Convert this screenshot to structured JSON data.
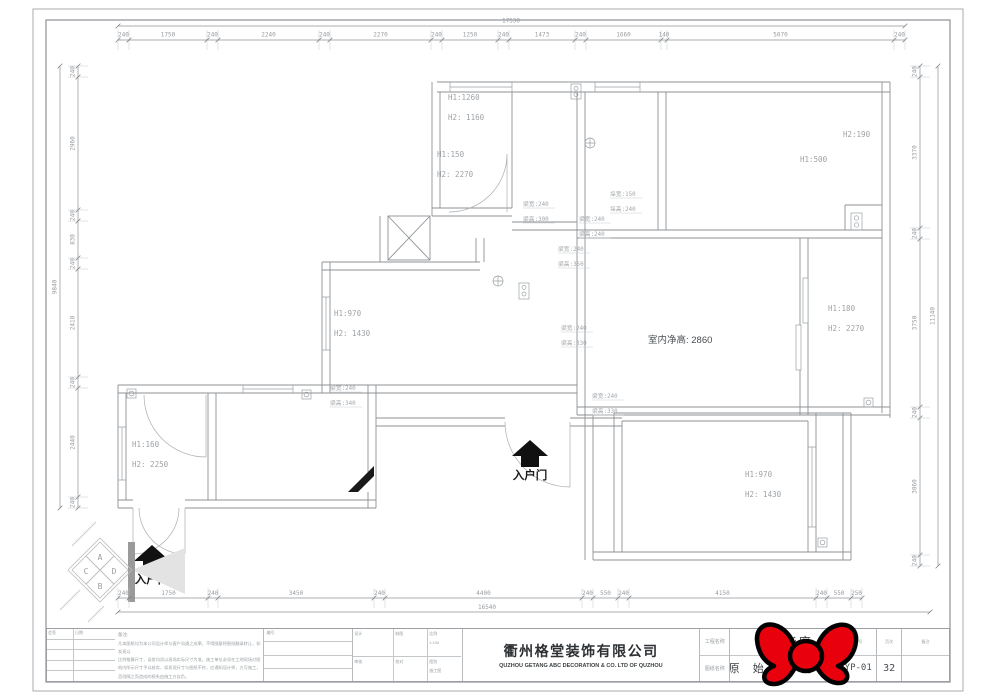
{
  "colors": {
    "line": "#8d9195",
    "dim_text": "#989ca0",
    "room_text": "#9ea2a6",
    "beam_text": "#a3a7ab",
    "dark_text": "#3c4043",
    "sticker_red": "#e8000d"
  },
  "dimensions": {
    "top": {
      "overall": "17530",
      "segments": [
        "240",
        "1750",
        "240",
        "2240",
        "240",
        "2270",
        "240",
        "1250",
        "240",
        "1473",
        "240",
        "1660",
        "140",
        "5070",
        "240"
      ]
    },
    "bottom": {
      "overall": "16540",
      "segments": [
        "240",
        "1750",
        "240",
        "3450",
        "240",
        "4400",
        "240",
        "550",
        "240",
        "4150",
        "240",
        "550",
        "250"
      ]
    },
    "left": {
      "overall": "9840",
      "segments": [
        "240",
        "2960",
        "240",
        "830",
        "240",
        "2410",
        "240",
        "2440",
        "240"
      ]
    },
    "right": {
      "overall": "11140",
      "segments": [
        "240",
        "3370",
        "240",
        "3750",
        "240",
        "3060",
        "240"
      ]
    }
  },
  "room_labels": [
    {
      "lines": [
        "H1:1260",
        "H2: 1160"
      ]
    },
    {
      "lines": [
        "H1:150",
        "H2: 2270"
      ]
    },
    {
      "lines": [
        "H1:500"
      ]
    },
    {
      "lines": [
        "H2:190"
      ]
    },
    {
      "lines": [
        "H1:970",
        "H2: 1430"
      ]
    },
    {
      "lines": [
        "H1:160",
        "H2: 2250"
      ]
    },
    {
      "lines": [
        "H1:180",
        "H2: 2270"
      ]
    },
    {
      "lines": [
        "H1:970",
        "H2: 1430"
      ]
    }
  ],
  "beam_labels": [
    {
      "lines": [
        "梁宽:240",
        "梁高:300"
      ]
    },
    {
      "lines": [
        "梁宽:240",
        "梁高:240"
      ]
    },
    {
      "lines": [
        "垛宽:150",
        "垛高:240"
      ]
    },
    {
      "lines": [
        "梁宽:240",
        "梁高:350"
      ]
    },
    {
      "lines": [
        "梁宽:240",
        "梁高:330"
      ]
    },
    {
      "lines": [
        "梁宽:240",
        "梁高:330"
      ]
    },
    {
      "lines": [
        "梁宽:240",
        "梁高:340"
      ]
    }
  ],
  "labels": {
    "ceiling_height": "室内净高: 2860",
    "entrance": "入户门"
  },
  "compass": {
    "letters": [
      "A",
      "C",
      "D",
      "B"
    ]
  },
  "title_block": {
    "sign_col_1": "会签",
    "sign_col_2": "日期",
    "notes_title": "备注:",
    "notes_lines": [
      "凡本图纸均为本公司设计师与客户沟通之成果，不得随意将图纸翻录转让，如发现以",
      "比例推算尺寸，误差均须以现场实际尺寸为准，施工单位必须在工地现场对图",
      "纸内所示尺寸予以核实，如发现尺寸与图纸不符，应通知设计师，方可施工，",
      "否则随之而造成的损失由施工方自负。"
    ],
    "serial_label": "编号",
    "mid_cells": [
      [
        "设计",
        ""
      ],
      [
        "制图",
        ""
      ],
      [
        "比例",
        "1:100"
      ],
      [
        "审核",
        ""
      ],
      [
        "校对",
        ""
      ],
      [
        "图别",
        "施工图"
      ]
    ],
    "company_cn": "衢州格堂装饰有限公司",
    "company_en": "QUZHOU GETANG ABC DECORATION  &  CO. LTD OF QUZHOU",
    "project_label": "工程名称",
    "drawing_label": "图纸名称",
    "project_name": "吾悦华府",
    "drawing_name": "原 始 结 构 图",
    "no_label": "图号",
    "drawing_no": "YP-01",
    "page_label": "页次",
    "page_no": "32",
    "extra_label": "备注"
  }
}
